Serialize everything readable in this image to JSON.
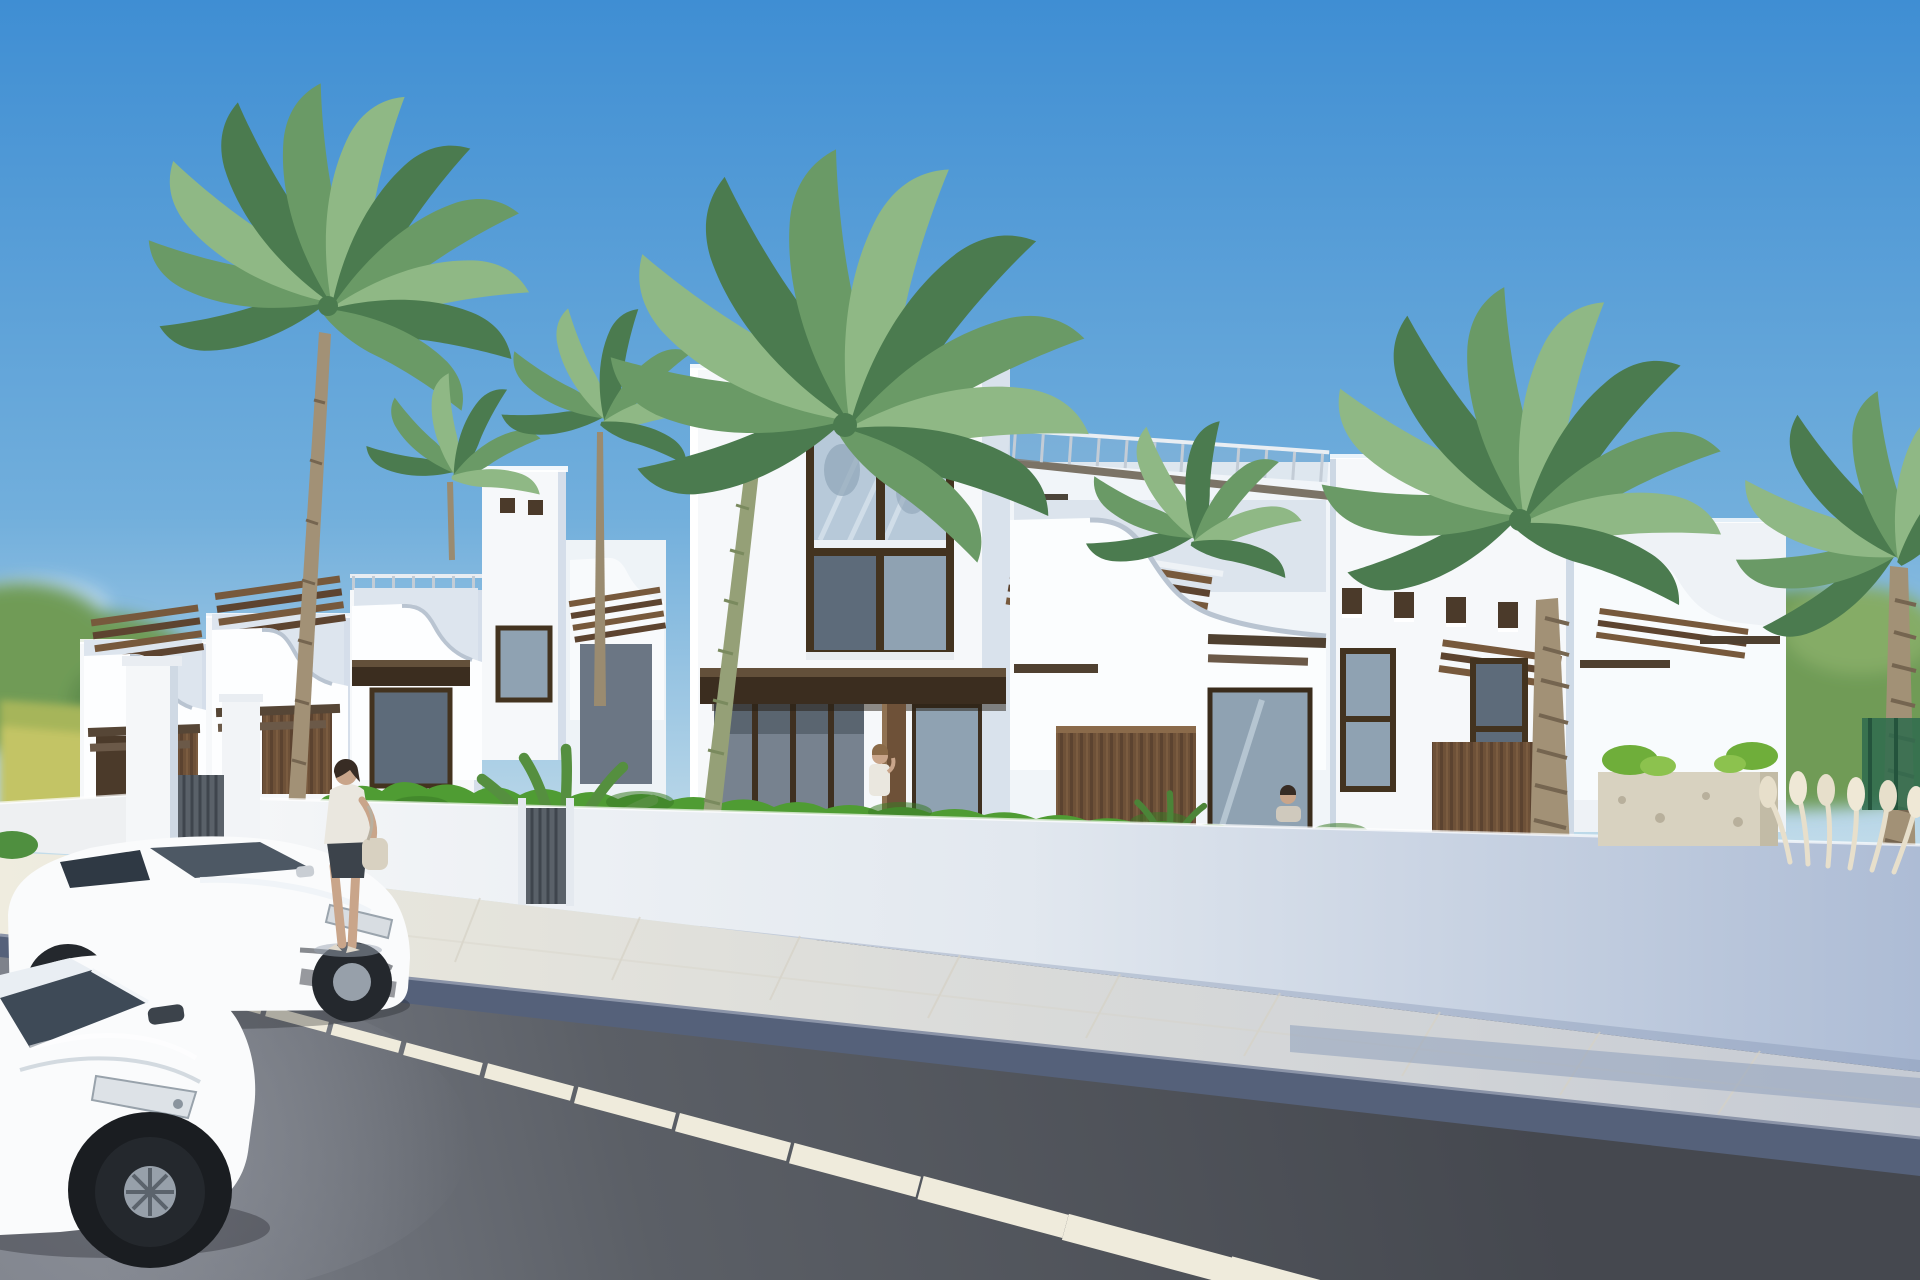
{
  "scene": {
    "type": "3d-architectural-rendering",
    "setting": "New-build row of white Mediterranean-style townhouses with curved balcony parapets, wooden pergolas and wood-clad panels, behind a white perimeter wall on a sunny street",
    "sky": "clear blue sky, paler toward the horizon",
    "people_count": 3,
    "car_count": 2,
    "car_color": "white",
    "palm_tree_count": 7,
    "road_marking": "dashed white centre line receding diagonally",
    "wall": "white rendered perimeter wall with dark slatted gates, shaded blue-grey to the right",
    "vegetation": "bright hedges, fern bushes, shrub planter, pampas grass, blurred background trees, yellow field at far left"
  },
  "palette": {
    "sky_top": "#3F8ED3",
    "sky_mid": "#72AFDC",
    "sky_horizon": "#D6E7ED",
    "bldg_white": "#F6F8FA",
    "bldg_shade": "#DCE4ED",
    "wood_dark": "#3B2D1F",
    "wood_mid": "#77593C",
    "wood_panel": "#6E5138",
    "frame_dark": "#43331F",
    "glass_light": "#B7C9D9",
    "glass_mid": "#8FA2B2",
    "glass_dark": "#5D6B7A",
    "hedge_green": "#4F9C33",
    "fern_green": "#558F3F",
    "palm_dark": "#4B7B4F",
    "palm_mid": "#6A9A66",
    "palm_light": "#8FB885",
    "trunk": "#A29176",
    "tree_bg": "#6F9B57",
    "field": "#C3C465",
    "wall_light": "#F7F8F9",
    "wall_mid": "#E2E8EF",
    "wall_shade": "#ADBCD5",
    "sidewalk": "#EFECDF",
    "sidewalk_shade": "#C6CBD4",
    "curb": "#55617A",
    "road_dark": "#45484F",
    "road_mid": "#5B5F66",
    "road_light": "#7E828B",
    "marking": "#EFEBDC",
    "car_white": "#FAFBFC",
    "car_window": "#3E4A57",
    "tyre": "#24282D",
    "rim": "#97A0AA",
    "skin": "#C9A58A",
    "hair_dark": "#382C24",
    "outfit_white": "#EAE7DF",
    "outfit_dark": "#3C434B",
    "bag": "#D8D1C1",
    "planter": "#D8D2C0",
    "pampas": "#E7DFCB",
    "fence_green": "#2E6B4E",
    "gate_gray": "#5A6169"
  }
}
